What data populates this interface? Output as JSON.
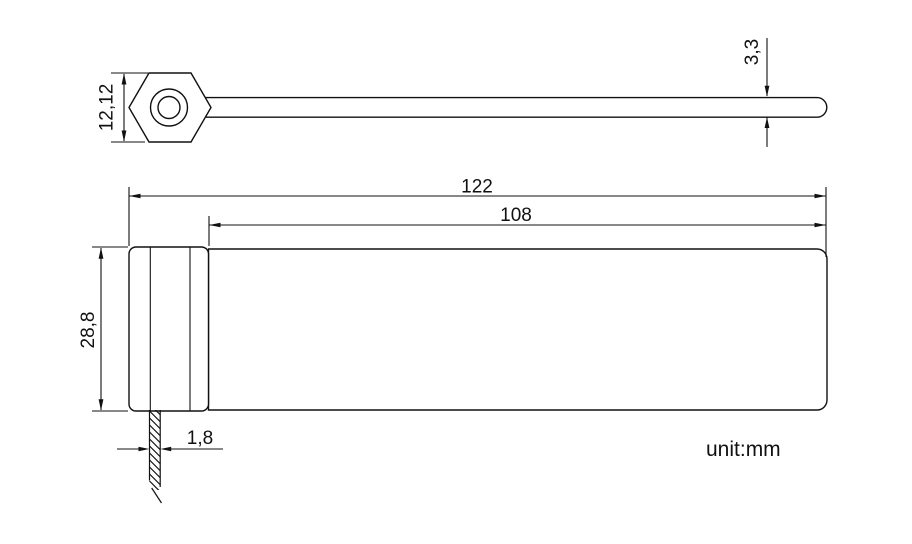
{
  "drawing": {
    "unit_label": "unit:mm",
    "stroke_color": "#111111",
    "background_color": "#ffffff",
    "side_view": {
      "description": "side profile of security seal: hexagonal head with lock hole and long strap with rounded tip",
      "head_height_label": "12,12",
      "strap_tip_thickness_label": "3,3"
    },
    "plan_view": {
      "description": "plan view of security seal: head with slot and flat strap body",
      "overall_length_label": "122",
      "strap_length_label": "108",
      "head_width_label": "28,8",
      "strap_cross_section_label": "1,8"
    }
  }
}
